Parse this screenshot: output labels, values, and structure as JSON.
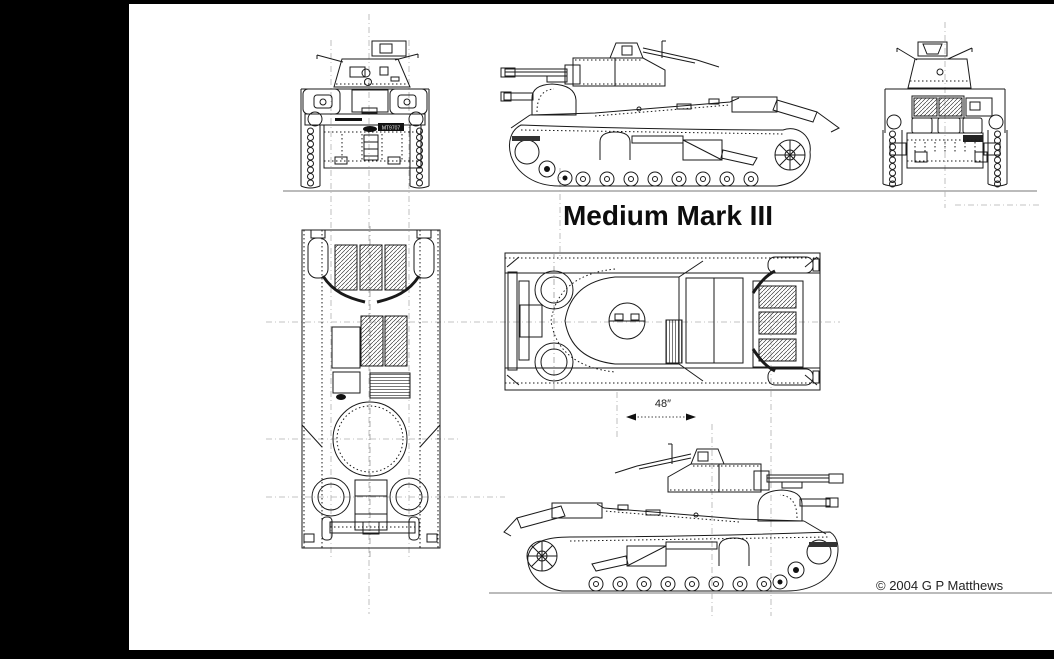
{
  "page": {
    "background": "#000000",
    "paper_color": "#ffffff",
    "line_color": "#1a1a1a",
    "guide_color": "#b0b0b0",
    "ground_color": "#777777"
  },
  "title": {
    "text": "Medium Mark III"
  },
  "scale_marker": {
    "label": "48″"
  },
  "copyright": {
    "text": "© 2004 G P Matthews"
  },
  "drawing": {
    "subject": "Medium Mark III tank, multi-view blueprint line drawing",
    "registration_plate": "MT9707",
    "views": [
      {
        "id": "front-view"
      },
      {
        "id": "side-view-facing-left"
      },
      {
        "id": "rear-view"
      },
      {
        "id": "plan-view-front-down"
      },
      {
        "id": "plan-view-front-left"
      },
      {
        "id": "side-view-facing-right"
      }
    ]
  }
}
